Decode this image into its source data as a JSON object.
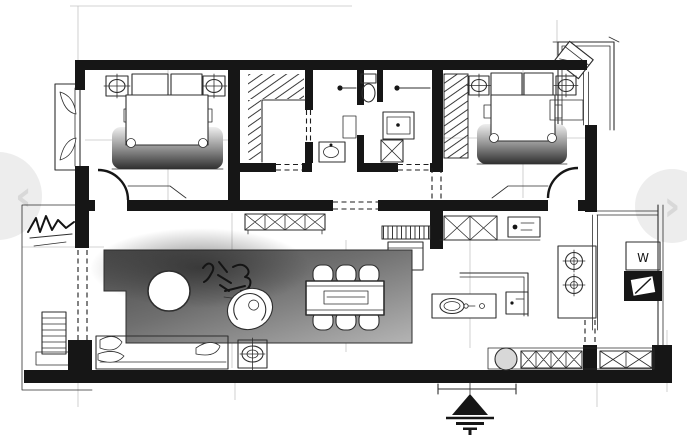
{
  "viewer": {
    "prev": {
      "icon": "chevron-left-icon",
      "glyph": "‹"
    },
    "next": {
      "icon": "chevron-right-icon",
      "glyph": "›"
    }
  },
  "floorplan": {
    "kind": "hand-drawn apartment floor plan sketch (ink and marker)",
    "labels": {
      "washer": "W"
    },
    "depicted": {
      "rooms": [
        "master bedroom",
        "walk-in closet",
        "bathroom with toilet and shower",
        "second bedroom",
        "living room",
        "dining area",
        "kitchen",
        "utility corner",
        "balcony top-right",
        "balcony left with plant"
      ],
      "furniture": [
        "double bed x2",
        "nightstands with lamps",
        "wardrobe with hanging clothes x2",
        "toilet",
        "shower heads",
        "vanity sinks",
        "sofa with cushions",
        "round coffee table",
        "swivel lounge chair",
        "side table with lamp",
        "dining table with six chairs",
        "sideboards with X bracing",
        "kitchen island with sink",
        "two-burner cooktop",
        "counter with round sink",
        "washing machine",
        "appliance cabinet",
        "ladder radiator on balcony",
        "outdoor chair",
        "designer calligraphy signature",
        "north ground symbol"
      ]
    },
    "colors": {
      "wall": "#161616",
      "line": "#2e2e2e",
      "guide": "#c4c4c4",
      "rug_dark": "#3f3f3f",
      "rug_light": "#b4b4b4",
      "sink_fill": "#d8d8d8",
      "nav_circle": "#e9e9e9",
      "nav_glyph": "#cfcfcf",
      "background": "#ffffff"
    }
  }
}
